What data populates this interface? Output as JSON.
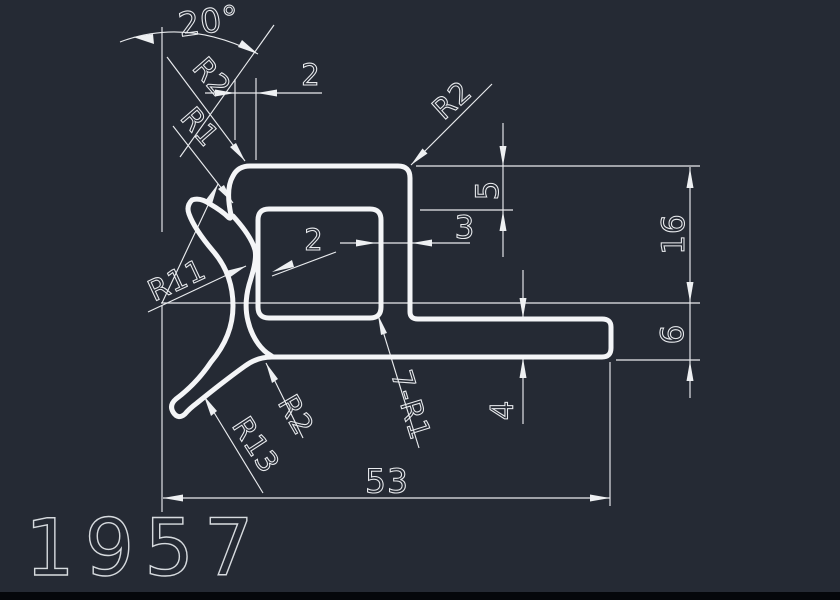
{
  "drawing": {
    "part_number": "1957",
    "colors": {
      "background": "#252a34",
      "line": "#e9ebee",
      "profile": "#f4f5f7"
    },
    "labels": {
      "angle": "20°",
      "gap_top": "2",
      "r2_upper": "R2",
      "r1_upper": "R1",
      "r2_corner": "R2",
      "depth_5": "5",
      "wall_3": "3",
      "height_16": "16",
      "r11": "R11",
      "wall_2": "2",
      "height_6": "6",
      "r2_lower": "R2",
      "fillets_7r1": "7-R1",
      "leg_4": "4",
      "r13": "R13",
      "width_53": "53"
    }
  }
}
